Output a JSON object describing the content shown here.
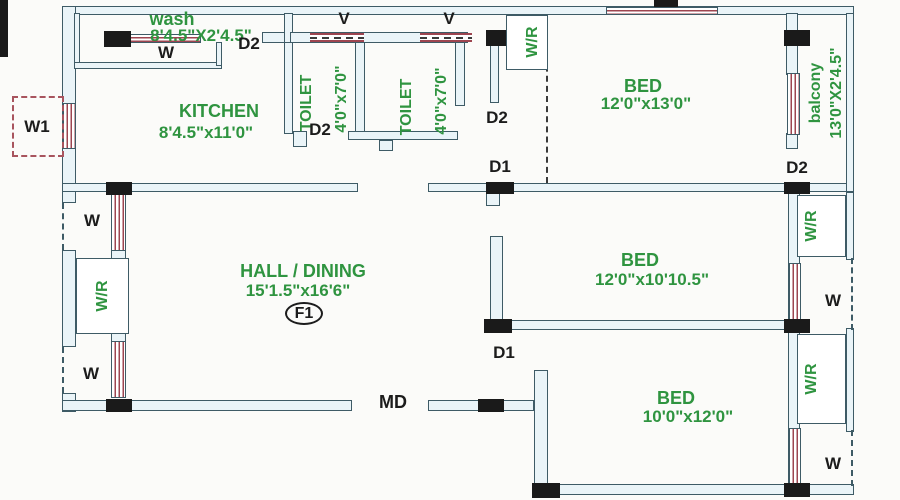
{
  "plan": {
    "rooms": {
      "wash": {
        "name": "wash",
        "dims": "8'4.5\"X2'4.5\""
      },
      "kitchen": {
        "name": "KITCHEN",
        "dims": "8'4.5\"x11'0\""
      },
      "toilet1": {
        "name": "TOILET",
        "dims": "4'0\"x7'0\""
      },
      "toilet2": {
        "name": "TOILET",
        "dims": "4'0\"x7'0\""
      },
      "bed1": {
        "name": "BED",
        "dims": "12'0\"x13'0\""
      },
      "balcony": {
        "name": "balcony",
        "dims": "13'0\"X2'4.5\""
      },
      "bed2": {
        "name": "BED",
        "dims": "12'0\"x10'10.5\""
      },
      "bed3": {
        "name": "BED",
        "dims": "10'0\"x12'0\""
      },
      "hall": {
        "name": "HALL / DINING",
        "dims": "15'1.5\"x16'6\"",
        "flat_no": "F1"
      }
    },
    "markers": {
      "window": "W",
      "window1": "W1",
      "wardrobe": "W/R",
      "door1": "D1",
      "door2": "D2",
      "main_door": "MD",
      "ventilator": "V"
    },
    "colors": {
      "wall_line": "#3e5b66",
      "wall_fill": "#eaf4f8",
      "window_stripe": "#9d4550",
      "label_green": "#2f9440",
      "label_black": "#1c1c1c",
      "pier_black": "#1a1a1a"
    }
  }
}
